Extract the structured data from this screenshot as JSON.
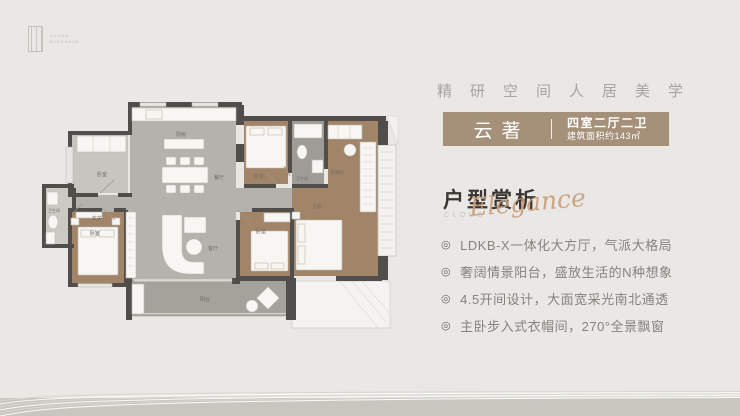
{
  "page": {
    "background_color": "#e9e8e5",
    "footer_band_color": "#c8c7bf"
  },
  "logo": {
    "line1": "CLOUD",
    "line2": "ELEGANCE"
  },
  "tagline": {
    "text": "精研空间人居美学"
  },
  "badge": {
    "name": "云著",
    "layout_type": "四室二厅二卫",
    "area": "建筑面积约143㎡",
    "bg_color": "#a5907a",
    "text_color": "#ffffff"
  },
  "section": {
    "title": "户型赏析",
    "eyebrow": "CLOUD",
    "script": "Elegance",
    "title_color": "#3a3632",
    "script_color": "#c99d7b"
  },
  "features": {
    "marker": "◎",
    "items": [
      "LDKB-X一体化大方厅，气派大格局",
      "奢阔情景阳台，盛放生活的N种想象",
      "4.5开间设计，大面宽采光南北通透",
      "主卧步入式衣帽间，270°全景飘窗"
    ]
  },
  "floor_plan": {
    "labels": {
      "kitchen": "厨房",
      "dining": "餐厅",
      "living": "客厅",
      "entry": "玄关",
      "balcony": "阳台",
      "bedroom_top_left": "卧室",
      "bedroom_bottom_left": "卧室",
      "bedroom_bottom_mid": "卧室",
      "bedroom_top_right": "卧室",
      "master": "主卧",
      "cloakroom": "衣帽间",
      "bath_left": "卫生间",
      "bath_right": "卫生间"
    },
    "colors": {
      "wall": "#4f4e4b",
      "floor_gray": "#b4b2ac",
      "floor_wood": "#a28569",
      "floor_balcony": "#a4a29b",
      "floor_tile": "#9e9c97",
      "furniture": "#f7f6f2"
    }
  }
}
